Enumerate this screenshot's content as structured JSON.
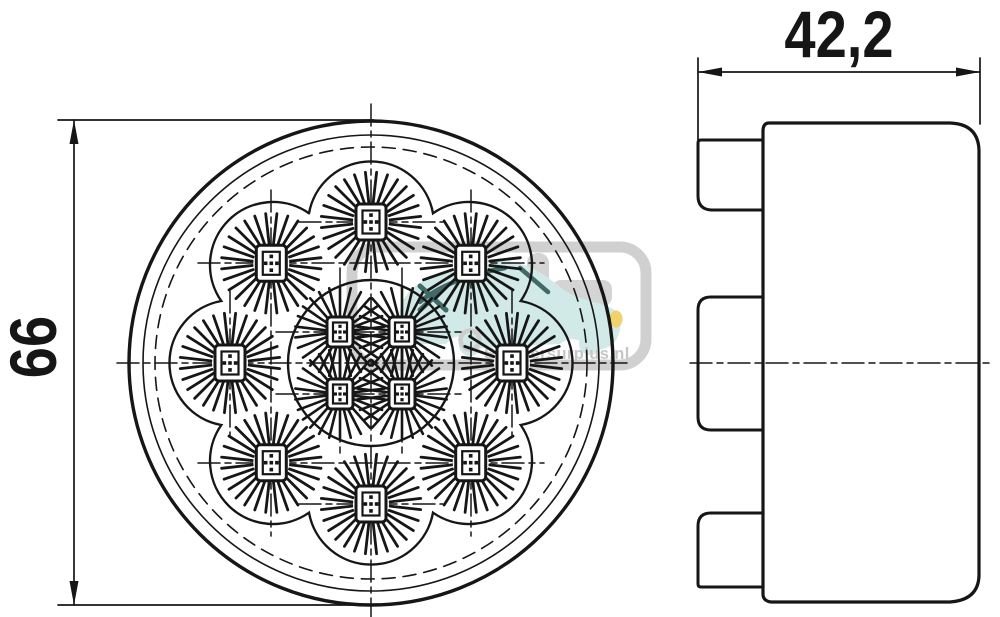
{
  "page": {
    "background": "#ffffff",
    "ink": "#161616"
  },
  "dimensions": {
    "height_label": "66",
    "depth_label": "42,2"
  },
  "watermark": {
    "text": "Sempersurplus.nl",
    "text_color": "#bdbdbd",
    "frame_gray": "#c8c8c8",
    "car_fill_teal": "#c9e6e3",
    "car_outline_teal": "#20514d",
    "headlight_yellow": "#f1c953"
  },
  "figure": {
    "front": {
      "cx": 371,
      "cy": 363,
      "rings": [
        {
          "r": 242,
          "w": 3.4
        },
        {
          "r": 228,
          "w": 1.6
        },
        {
          "r": 216,
          "w": 1.6,
          "dash": "13 8"
        }
      ],
      "cluster_ring": {
        "r": 83,
        "w": 2.4
      },
      "scallop": {
        "ring_r": 141,
        "lobe_r": 63,
        "cusp_r": 162,
        "count": 8,
        "start_deg": -90,
        "w": 2.4
      },
      "outer_leds": {
        "ring_r": 141,
        "count": 8,
        "start_deg": -90,
        "spokes": 28,
        "r_in": 19,
        "r_out": 50,
        "spoke_w": 2.8,
        "sq_w": 30,
        "sq_h": 36,
        "sq2_w": 17,
        "sq2_h": 23,
        "dot": 3.6
      },
      "inner_leds": {
        "dx": 31,
        "dy": 31,
        "spokes": 26,
        "r_in": 15,
        "r_out": 45,
        "spoke_w": 2.6,
        "sq_w": 26,
        "sq_h": 30,
        "sq2_w": 14,
        "sq2_h": 19,
        "dot": 3.2
      },
      "centerlines": [
        [
          371,
          104,
          371,
          619
        ],
        [
          117,
          363,
          627,
          363
        ],
        [
          198,
          263,
          544,
          263
        ],
        [
          198,
          463,
          544,
          463
        ],
        [
          271,
          190,
          271,
          536
        ],
        [
          471,
          190,
          471,
          536
        ],
        [
          230,
          291,
          230,
          435
        ],
        [
          512,
          291,
          512,
          435
        ],
        [
          299,
          222,
          443,
          222
        ],
        [
          299,
          504,
          443,
          504
        ],
        [
          340,
          268,
          340,
          458
        ],
        [
          402,
          268,
          402,
          458
        ],
        [
          276,
          332,
          466,
          332
        ],
        [
          276,
          394,
          466,
          394
        ]
      ]
    }
  }
}
